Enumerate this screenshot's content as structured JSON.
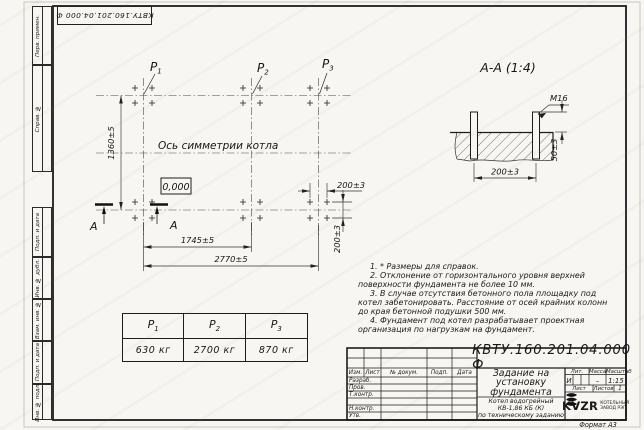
{
  "stamp_top": "КВТУ.160.201.04.000 Ф",
  "margin": {
    "items": [
      "Перв. примен.",
      "Справ. №",
      "Подп. и дата",
      "Инв. № дубл.",
      "Взам. инв. №",
      "Подп. и дата",
      "Инв. № подл."
    ]
  },
  "plan": {
    "symmetry_label": "Ось симметрии котла",
    "level": "0,000",
    "points": [
      {
        "base": "P",
        "sub": "1"
      },
      {
        "base": "P",
        "sub": "2"
      },
      {
        "base": "P",
        "sub": "3"
      }
    ],
    "dims": {
      "height": "1360±5",
      "span1": "1745±5",
      "span2": "2770±5",
      "bolt_x": "200±3",
      "bolt_y": "200±3"
    },
    "section_letter_left": "А",
    "section_letter_right": "А"
  },
  "section": {
    "title": "А-А (1:4)",
    "thread": "М16",
    "protrusion": "50±3",
    "spacing": "200±3"
  },
  "loads": {
    "headers": [
      {
        "base": "P",
        "sub": "1"
      },
      {
        "base": "P",
        "sub": "2"
      },
      {
        "base": "P",
        "sub": "3"
      }
    ],
    "values": [
      "630 кг",
      "2700 кг",
      "870 кг"
    ]
  },
  "notes": [
    "1. * Размеры для справок.",
    "2. Отклонение от горизонтального уровня верхней поверхности фундамента не более 10 мм.",
    "3. В случае отсутствия бетонного пола площадку под котел забетонировать. Расстояние от осей крайних колонн до края бетонной подушки 500 мм.",
    "4. Фундамент под котел разрабатывает проектная организация по нагрузкам на фундамент."
  ],
  "title_block": {
    "doc_number": "КВТУ.160.201.04.000 Ф",
    "title_lines": [
      "Задание на",
      "установку",
      "фундамента"
    ],
    "product_lines": [
      "Котел водогрейный",
      "КВ-1,86 КБ (К)",
      "по техническому заданию"
    ],
    "change_header": [
      "Изм.",
      "Лист",
      "№ докум.",
      "Подп.",
      "Дата"
    ],
    "roles": [
      "Разраб.",
      "Пров.",
      "Т.контр.",
      "Н.контр.",
      "Утв."
    ],
    "lit_label": "Лит.",
    "lit_value": "И",
    "mass_label": "Масса",
    "mass_value": "–",
    "scale_label": "Масштаб",
    "scale_value": "1:15",
    "sheet_label": "Лист",
    "sheets_label": "Листов",
    "sheets_value": "1",
    "logo_text": "KVZR",
    "logo_caption_lines": [
      "КОТЕЛЬНЫЙ",
      "ЗАВОД РЭП"
    ],
    "format": "Формат А3"
  }
}
